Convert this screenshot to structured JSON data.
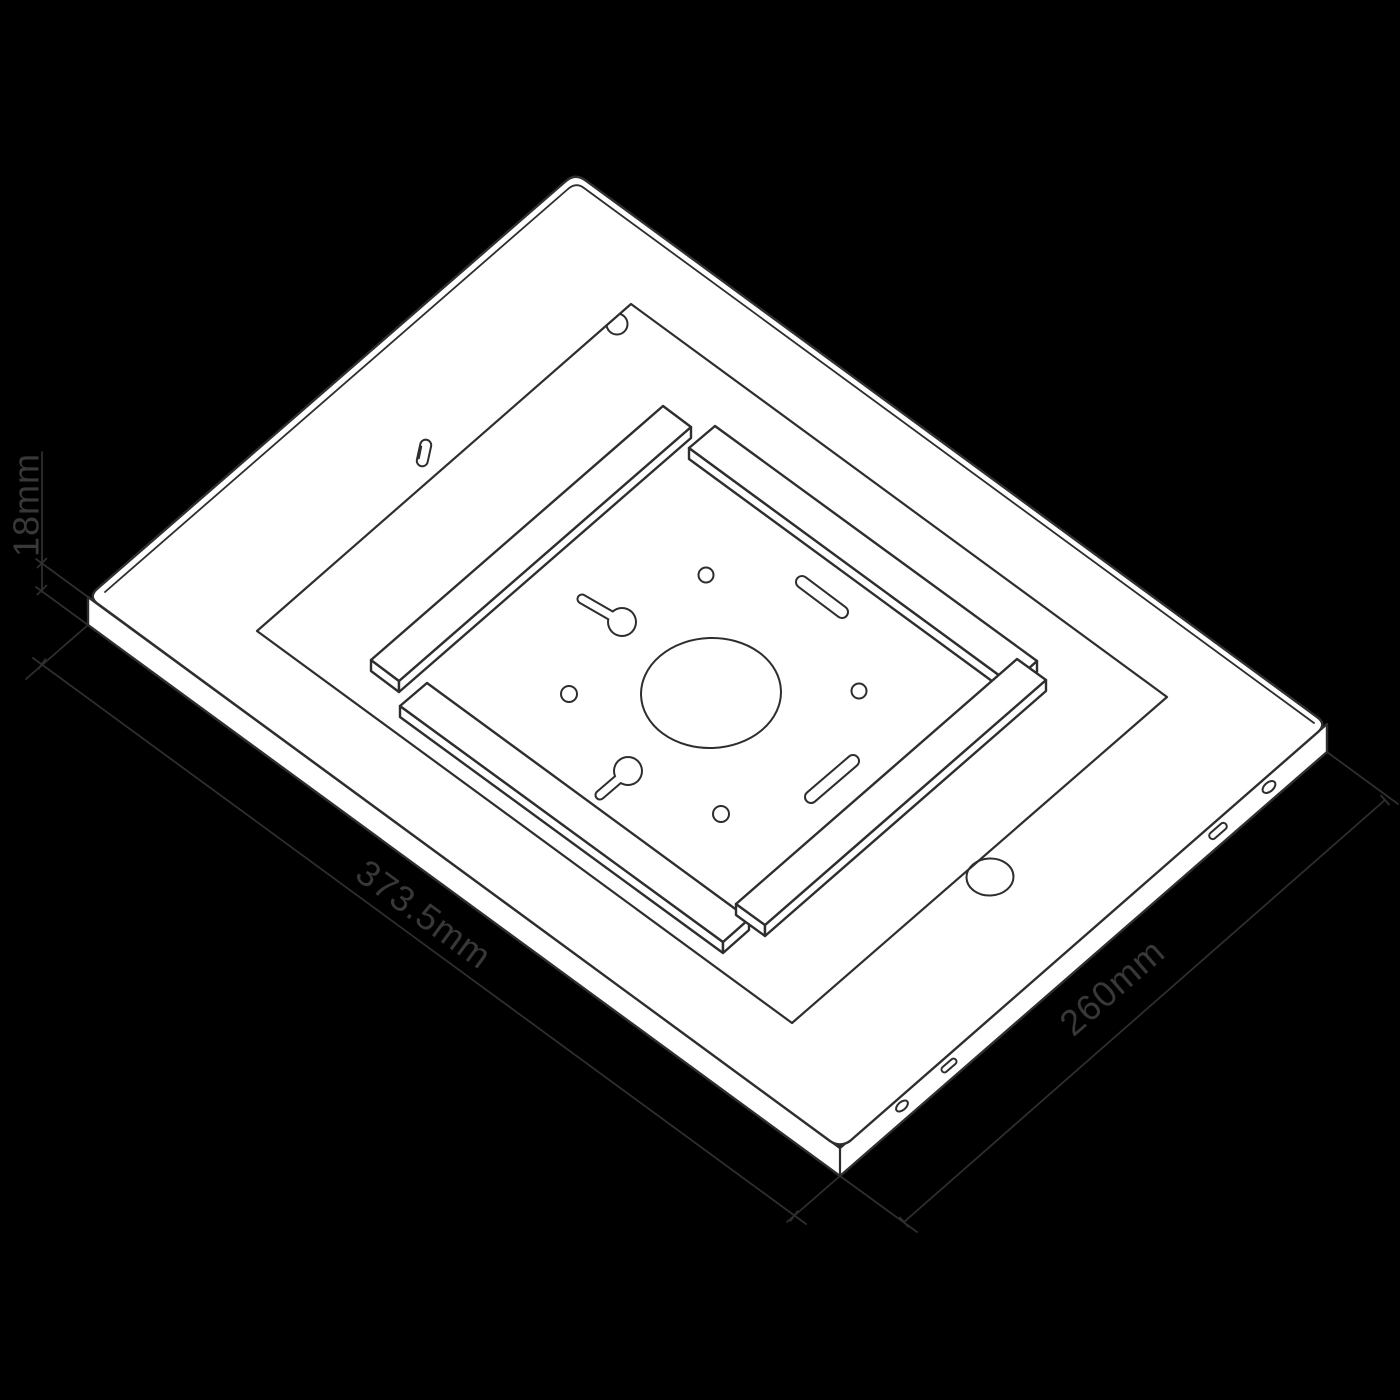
{
  "page": {
    "background_color": "#000000"
  },
  "drawing": {
    "kind": "isometric-dimension-drawing",
    "subject": "tablet-enclosure-back-plate",
    "surface_color": "#ffffff",
    "line_color": "#2e2e2e",
    "text_color": "#383838",
    "labels": {
      "thickness": "18mm",
      "length": "373.5mm",
      "width": "260mm"
    },
    "features": [
      "back-plate-top-face",
      "side-wall",
      "side-wall-port-cutouts",
      "tablet-recess",
      "corner-camera-hole",
      "retention-rails",
      "keyhole-mount-slots",
      "vesa-screw-holes",
      "center-cable-hole",
      "home-button-hole",
      "security-screw-slot"
    ]
  }
}
